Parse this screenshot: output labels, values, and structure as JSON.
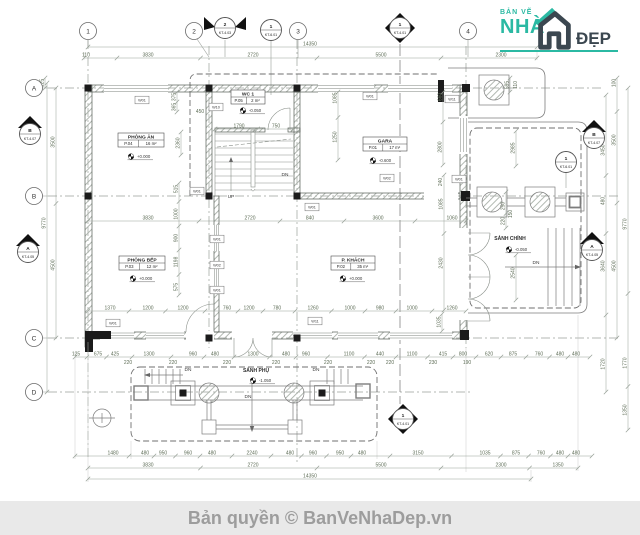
{
  "page": {
    "background": "#ffffff"
  },
  "logo": {
    "top_text": "BẢN VẼ",
    "brand_left": "NHÀ",
    "brand_right": "ĐẸP",
    "teal": "#2bb9a3",
    "dark": "#3b4750"
  },
  "footer": {
    "text": "Bản quyền © BanVeNhaDep.vn",
    "background": "#e9e9e9",
    "color": "#9d9d9d"
  },
  "drawing": {
    "colors": {
      "line": "#8f968f",
      "wall": "#555c55",
      "hatch": "#a9b0a9",
      "column": "#1b1b1b",
      "dim_line": "#97a097",
      "dim_text": "#5f6e58",
      "label_text": "#2b2b2b",
      "note_text": "#3c3c3c"
    },
    "grid_bubbles": [
      {
        "label": "1",
        "x": 88,
        "y": 31
      },
      {
        "label": "2",
        "x": 194,
        "y": 31
      },
      {
        "label": "3",
        "x": 298,
        "y": 31
      },
      {
        "label": "4",
        "x": 468,
        "y": 31
      },
      {
        "label": "A",
        "x": 34,
        "y": 88
      },
      {
        "label": "B",
        "x": 34,
        "y": 196
      },
      {
        "label": "C",
        "x": 34,
        "y": 338
      },
      {
        "label": "D",
        "x": 34,
        "y": 392
      }
    ],
    "markers": [
      {
        "shape": "flag",
        "a": "2",
        "b": "KT-4.03",
        "x": 225,
        "y": 28
      },
      {
        "shape": "circle",
        "a": "1",
        "b": "KT-6.01",
        "x": 271,
        "y": 30
      },
      {
        "shape": "diamond",
        "a": "1",
        "b": "KT-4.01",
        "x": 400,
        "y": 28
      },
      {
        "shape": "tri",
        "a": "B",
        "b": "KT-4.07",
        "x": 30,
        "y": 129
      },
      {
        "shape": "tri",
        "a": "A",
        "b": "KT-4.05",
        "x": 28,
        "y": 247
      },
      {
        "shape": "tri",
        "a": "B",
        "b": "KT-4.07",
        "x": 594,
        "y": 133
      },
      {
        "shape": "circle",
        "a": "1",
        "b": "KT-6.01",
        "x": 566,
        "y": 162
      },
      {
        "shape": "tri",
        "a": "A",
        "b": "KT-4.05",
        "x": 592,
        "y": 245
      },
      {
        "shape": "diamond",
        "a": "1",
        "b": "KT-4.01",
        "x": 403,
        "y": 419
      }
    ],
    "rooms": [
      {
        "name": "PHÒNG ĂN",
        "code": "P.04",
        "area": "16 m²",
        "x": 118,
        "y": 133,
        "w": 46
      },
      {
        "name": "WC 1",
        "code": "P.05",
        "area": "2 m²",
        "x": 231,
        "y": 90,
        "w": 34
      },
      {
        "name": "GARA",
        "code": "P.01",
        "area": "17 m²",
        "x": 363,
        "y": 137,
        "w": 44
      },
      {
        "name": "PHÒNG BẾP",
        "code": "P.03",
        "area": "12 m²",
        "x": 119,
        "y": 256,
        "w": 46
      },
      {
        "name": "P. KHÁCH",
        "code": "P.02",
        "area": "35 m²",
        "x": 331,
        "y": 256,
        "w": 44
      }
    ],
    "levels": [
      {
        "value": "+0.000",
        "x": 137,
        "y": 158
      },
      {
        "value": "-0.050",
        "x": 249,
        "y": 112
      },
      {
        "value": "-0.600",
        "x": 379,
        "y": 162
      },
      {
        "value": "+0.000",
        "x": 139,
        "y": 280
      },
      {
        "value": "+0.000",
        "x": 349,
        "y": 280
      },
      {
        "value": "-0.050",
        "x": 515,
        "y": 251
      },
      {
        "value": "-1.050",
        "x": 259,
        "y": 382
      }
    ],
    "free_labels": [
      {
        "text": "SẢNH CHÍNH",
        "x": 510,
        "y": 240
      },
      {
        "text": "SẢNH PHỤ",
        "x": 256,
        "y": 372
      }
    ],
    "notes": [
      {
        "text": "UP",
        "x": 231,
        "y": 198
      },
      {
        "text": "DN",
        "x": 285,
        "y": 176
      },
      {
        "text": "DN",
        "x": 188,
        "y": 371
      },
      {
        "text": "DN",
        "x": 316,
        "y": 371
      },
      {
        "text": "DN",
        "x": 248,
        "y": 398
      },
      {
        "text": "DN",
        "x": 536,
        "y": 264
      }
    ],
    "wall_tags": [
      {
        "text": "W01",
        "x": 142,
        "y": 100
      },
      {
        "text": "W10",
        "x": 216,
        "y": 107
      },
      {
        "text": "W01",
        "x": 370,
        "y": 96
      },
      {
        "text": "W11",
        "x": 452,
        "y": 99
      },
      {
        "text": "W01",
        "x": 197,
        "y": 191
      },
      {
        "text": "W01",
        "x": 217,
        "y": 239
      },
      {
        "text": "W02",
        "x": 217,
        "y": 265
      },
      {
        "text": "W01",
        "x": 217,
        "y": 290
      },
      {
        "text": "W01",
        "x": 312,
        "y": 207
      },
      {
        "text": "W02",
        "x": 387,
        "y": 178
      },
      {
        "text": "W01",
        "x": 459,
        "y": 179
      },
      {
        "text": "W01",
        "x": 113,
        "y": 323
      },
      {
        "text": "W11",
        "x": 315,
        "y": 321
      }
    ],
    "dim_chains_h": [
      {
        "y": 47,
        "x1": 88,
        "x2": 537,
        "labels": [
          {
            "t": "14350",
            "x": 310
          }
        ]
      },
      {
        "y": 58,
        "x1": 84,
        "x2": 537,
        "labels": [
          {
            "t": "110",
            "x": 86
          },
          {
            "t": "3830",
            "x": 148
          },
          {
            "t": "2720",
            "x": 253
          },
          {
            "t": "5500",
            "x": 381
          },
          {
            "t": "2300",
            "x": 501
          }
        ]
      },
      {
        "y": 221,
        "x1": 88,
        "x2": 466,
        "labels": [
          {
            "t": "3830",
            "x": 148
          },
          {
            "t": "2720",
            "x": 250
          },
          {
            "t": "840",
            "x": 310
          },
          {
            "t": "3600",
            "x": 378
          },
          {
            "t": "1060",
            "x": 452
          }
        ]
      },
      {
        "y": 311,
        "x1": 88,
        "x2": 466,
        "labels": [
          {
            "t": "1370",
            "x": 110
          },
          {
            "t": "1200",
            "x": 148
          },
          {
            "t": "1200",
            "x": 183
          },
          {
            "t": "760",
            "x": 227
          },
          {
            "t": "1200",
            "x": 249
          },
          {
            "t": "780",
            "x": 277
          },
          {
            "t": "1260",
            "x": 313
          },
          {
            "t": "1000",
            "x": 350
          },
          {
            "t": "980",
            "x": 380
          },
          {
            "t": "1000",
            "x": 412
          },
          {
            "t": "1260",
            "x": 452
          }
        ]
      },
      {
        "y": 357,
        "x1": 75,
        "x2": 590,
        "labels": [
          {
            "t": "125",
            "x": 76
          },
          {
            "t": "675",
            "x": 98
          },
          {
            "t": "425",
            "x": 115
          },
          {
            "t": "1300",
            "x": 149
          },
          {
            "t": "960",
            "x": 193
          },
          {
            "t": "480",
            "x": 215
          },
          {
            "t": "1300",
            "x": 253
          },
          {
            "t": "480",
            "x": 286
          },
          {
            "t": "960",
            "x": 306
          },
          {
            "t": "1100",
            "x": 349
          },
          {
            "t": "440",
            "x": 380
          },
          {
            "t": "1100",
            "x": 412
          },
          {
            "t": "415",
            "x": 443
          },
          {
            "t": "800",
            "x": 463
          },
          {
            "t": "620",
            "x": 489
          },
          {
            "t": "875",
            "x": 513
          },
          {
            "t": "760",
            "x": 539
          },
          {
            "t": "480",
            "x": 560
          },
          {
            "t": "480",
            "x": 576
          }
        ]
      },
      {
        "y": 456,
        "x1": 75,
        "x2": 592,
        "labels": [
          {
            "t": "1480",
            "x": 113
          },
          {
            "t": "480",
            "x": 145
          },
          {
            "t": "950",
            "x": 163
          },
          {
            "t": "960",
            "x": 188
          },
          {
            "t": "480",
            "x": 212
          },
          {
            "t": "2240",
            "x": 252
          },
          {
            "t": "480",
            "x": 290
          },
          {
            "t": "960",
            "x": 313
          },
          {
            "t": "950",
            "x": 340
          },
          {
            "t": "480",
            "x": 362
          },
          {
            "t": "3150",
            "x": 418
          },
          {
            "t": "1035",
            "x": 485
          },
          {
            "t": "875",
            "x": 516
          },
          {
            "t": "760",
            "x": 541
          },
          {
            "t": "480",
            "x": 560
          },
          {
            "t": "480",
            "x": 576
          }
        ]
      },
      {
        "y": 468,
        "x1": 88,
        "x2": 578,
        "labels": [
          {
            "t": "3830",
            "x": 148
          },
          {
            "t": "2720",
            "x": 253
          },
          {
            "t": "5500",
            "x": 381
          },
          {
            "t": "2300",
            "x": 501
          },
          {
            "t": "1350",
            "x": 558
          }
        ]
      },
      {
        "y": 479,
        "x1": 88,
        "x2": 531,
        "labels": [
          {
            "t": "14350",
            "x": 310
          }
        ]
      },
      {
        "y": 129,
        "x1": 215,
        "x2": 293,
        "labels": [
          {
            "t": "1790",
            "x": 239
          },
          {
            "t": "750",
            "x": 276
          }
        ]
      }
    ],
    "dim_chains_v": [
      {
        "x": 47,
        "y1": 83,
        "y2": 392,
        "labels": [
          {
            "t": "9770",
            "y": 223
          }
        ]
      },
      {
        "x": 56,
        "y1": 88,
        "y2": 338,
        "labels": [
          {
            "t": "3500",
            "y": 142
          },
          {
            "t": "4500",
            "y": 265
          }
        ]
      },
      {
        "x": 45,
        "y1": 78,
        "y2": 88,
        "labels": [
          {
            "t": "125",
            "y": 83
          }
        ]
      },
      {
        "x": 606,
        "y1": 95,
        "y2": 392,
        "labels": [
          {
            "t": "3450",
            "y": 150
          },
          {
            "t": "480",
            "y": 201
          },
          {
            "t": "3640",
            "y": 266
          },
          {
            "t": "1720",
            "y": 364
          }
        ]
      },
      {
        "x": 617,
        "y1": 78,
        "y2": 338,
        "labels": [
          {
            "t": "100",
            "y": 83
          },
          {
            "t": "3500",
            "y": 140
          },
          {
            "t": "4500",
            "y": 266
          }
        ]
      },
      {
        "x": 628,
        "y1": 88,
        "y2": 430,
        "labels": [
          {
            "t": "9770",
            "y": 224
          },
          {
            "t": "1770",
            "y": 363
          },
          {
            "t": "1350",
            "y": 410
          }
        ]
      },
      {
        "x": 179,
        "y1": 183,
        "y2": 295,
        "labels": [
          {
            "t": "515",
            "y": 189
          },
          {
            "t": "1000",
            "y": 214
          },
          {
            "t": "900",
            "y": 238
          },
          {
            "t": "1198",
            "y": 262
          },
          {
            "t": "575",
            "y": 287
          }
        ]
      },
      {
        "x": 177,
        "y1": 92,
        "y2": 112,
        "labels": [
          {
            "t": "375",
            "y": 97
          },
          {
            "t": "365",
            "y": 107
          }
        ]
      },
      {
        "x": 338,
        "y1": 92,
        "y2": 160,
        "labels": [
          {
            "t": "1085",
            "y": 98
          },
          {
            "t": "1250",
            "y": 137
          }
        ]
      },
      {
        "x": 443,
        "y1": 92,
        "y2": 165,
        "labels": [
          {
            "t": "660",
            "y": 97
          },
          {
            "t": "2800",
            "y": 147
          }
        ]
      },
      {
        "x": 516,
        "y1": 131,
        "y2": 166,
        "labels": [
          {
            "t": "2985",
            "y": 148
          }
        ]
      },
      {
        "x": 510,
        "y1": 78,
        "y2": 92,
        "labels": [
          {
            "t": "595",
            "y": 85
          }
        ]
      },
      {
        "x": 444,
        "y1": 175,
        "y2": 310,
        "labels": [
          {
            "t": "1085",
            "y": 204
          },
          {
            "t": "2430",
            "y": 263
          }
        ]
      },
      {
        "x": 516,
        "y1": 255,
        "y2": 300,
        "labels": [
          {
            "t": "2540",
            "y": 273
          }
        ]
      },
      {
        "x": 506,
        "y1": 192,
        "y2": 228,
        "labels": [
          {
            "t": "250",
            "y": 206
          },
          {
            "t": "220",
            "y": 221
          }
        ]
      },
      {
        "x": 442,
        "y1": 314,
        "y2": 331,
        "labels": [
          {
            "t": "1035",
            "y": 322
          }
        ]
      },
      {
        "x": 181,
        "y1": 132,
        "y2": 155,
        "labels": [
          {
            "t": "2360",
            "y": 143
          }
        ]
      }
    ],
    "dims_loose": [
      {
        "t": "450",
        "x": 200,
        "y": 113
      },
      {
        "t": "220",
        "x": 128,
        "y": 364
      },
      {
        "t": "220",
        "x": 173,
        "y": 364
      },
      {
        "t": "220",
        "x": 227,
        "y": 364
      },
      {
        "t": "220",
        "x": 276,
        "y": 364
      },
      {
        "t": "220",
        "x": 328,
        "y": 364
      },
      {
        "t": "220",
        "x": 371,
        "y": 364
      },
      {
        "t": "220",
        "x": 390,
        "y": 364
      },
      {
        "t": "230",
        "x": 433,
        "y": 364
      },
      {
        "t": "190",
        "x": 467,
        "y": 364
      },
      {
        "t": "150",
        "x": 512,
        "y": 214,
        "r": 1
      },
      {
        "t": "110",
        "x": 517,
        "y": 85,
        "r": 1
      },
      {
        "t": "240",
        "x": 442,
        "y": 182,
        "r": 1
      }
    ]
  }
}
